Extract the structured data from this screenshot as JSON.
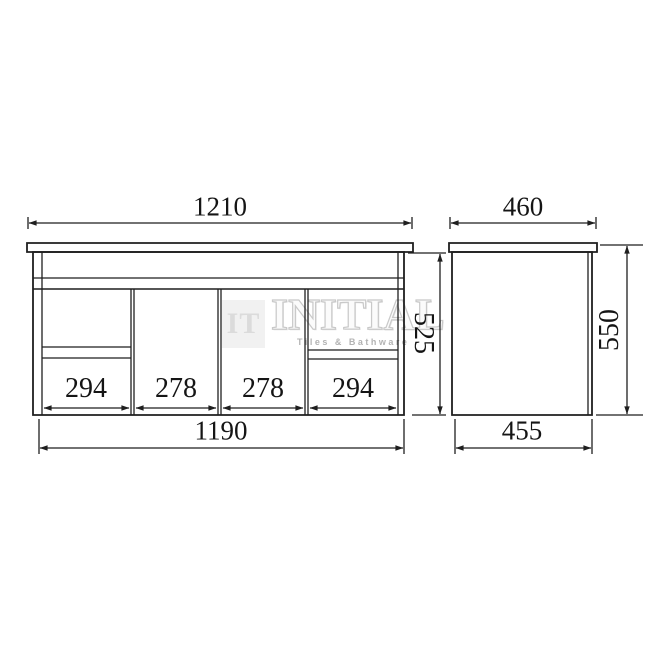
{
  "watermark": {
    "brand": "INITIAL",
    "tagline": "Tiles & Bathware",
    "logo_text": "IT"
  },
  "front_view": {
    "top_width": "1210",
    "bottom_width": "1190",
    "height": "525",
    "sections": [
      "294",
      "278",
      "278",
      "294"
    ]
  },
  "side_view": {
    "top_width": "460",
    "bottom_width": "455",
    "height": "550"
  },
  "colors": {
    "line": "#1f1f1f",
    "dimension_text": "#151515",
    "watermark_gray": "#c9c9c9",
    "background": "#ffffff"
  }
}
